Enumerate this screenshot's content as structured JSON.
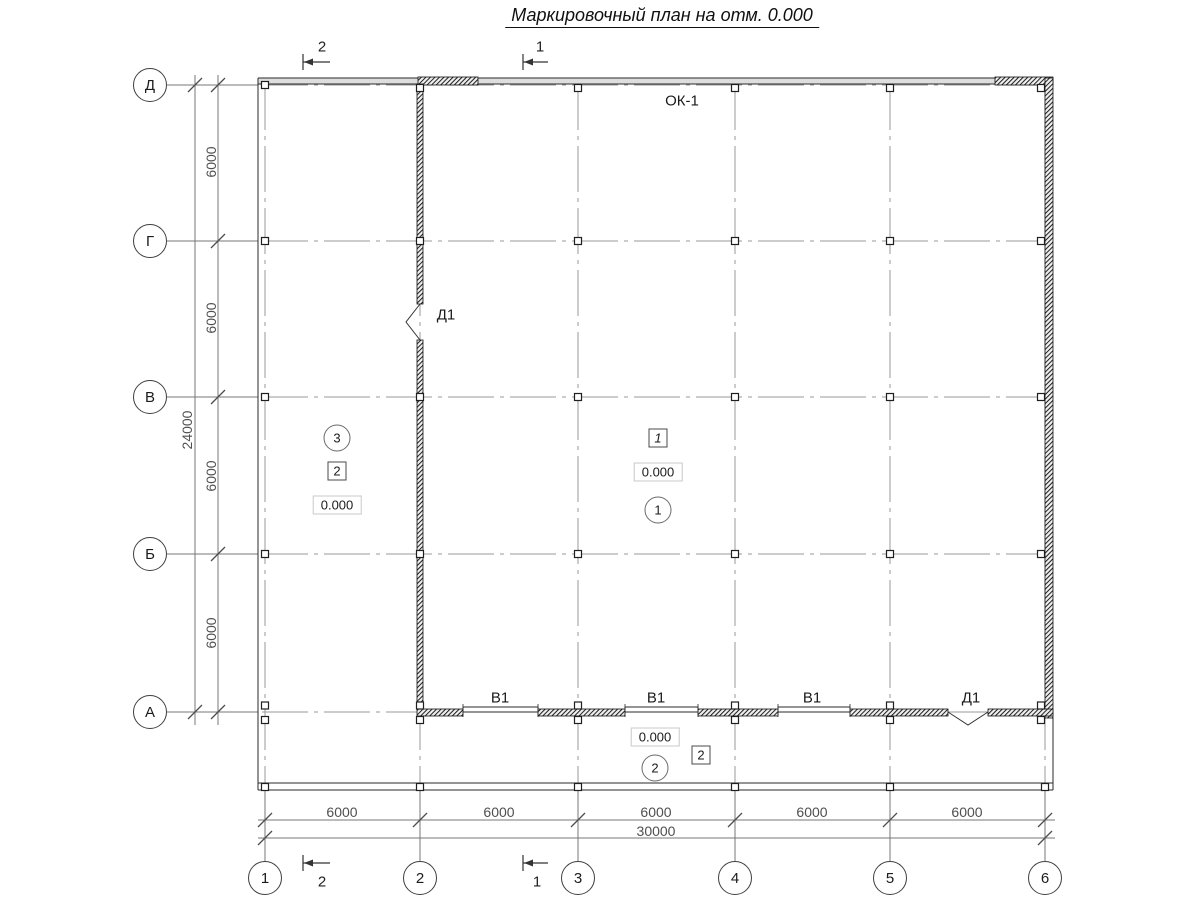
{
  "title": "Маркировочный план на отм. 0.000",
  "grid": {
    "row_labels": [
      "Д",
      "Г",
      "В",
      "Б",
      "А"
    ],
    "col_labels": [
      "1",
      "2",
      "3",
      "4",
      "5",
      "6"
    ]
  },
  "dims": {
    "v_bays": [
      "6000",
      "6000",
      "6000",
      "6000"
    ],
    "v_total": "24000",
    "h_bays": [
      "6000",
      "6000",
      "6000",
      "6000",
      "6000"
    ],
    "h_total": "30000"
  },
  "sections": {
    "top": [
      "2",
      "1"
    ],
    "bottom": [
      "2",
      "1"
    ]
  },
  "marks": {
    "window": "ОК-1",
    "door_wall": "Д1",
    "door_bottom": "Д1",
    "gates": [
      "В1",
      "В1",
      "В1"
    ]
  },
  "rooms": {
    "left": {
      "circle": "3",
      "box": "2",
      "level": "0.000"
    },
    "main": {
      "box": "1",
      "level": "0.000",
      "circle": "1"
    },
    "strip": {
      "level": "0.000",
      "circle": "2",
      "box": "2"
    }
  },
  "colors": {
    "wall": "#1f1f1f",
    "dimension_line": "#777777",
    "axis_line": "#999999",
    "window_band": "#dedede"
  }
}
